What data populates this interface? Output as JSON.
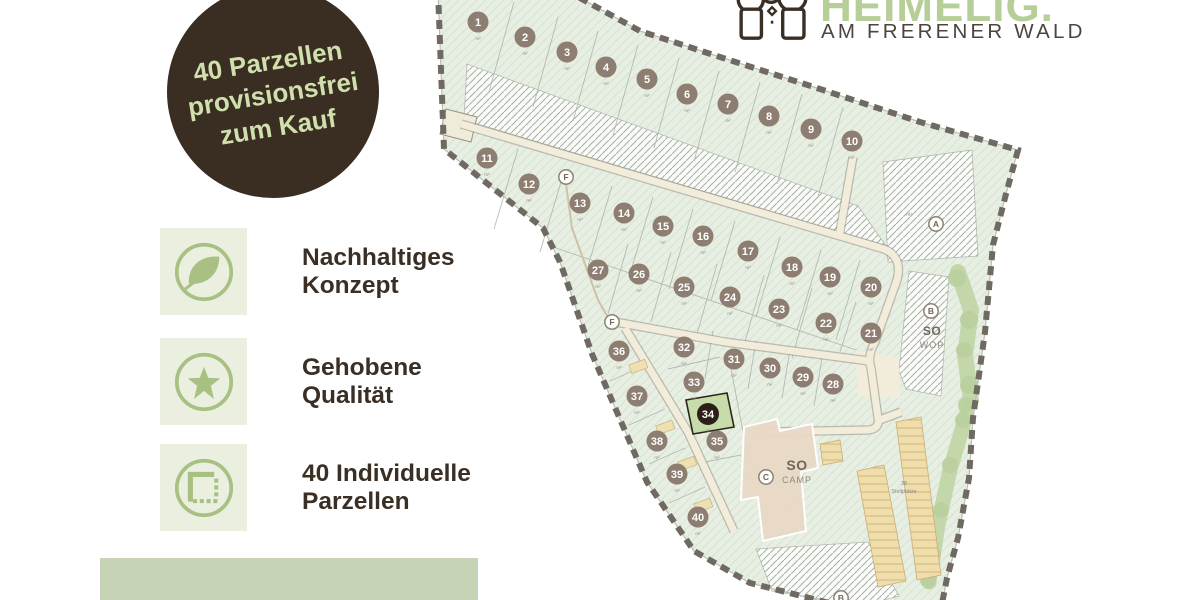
{
  "badge": {
    "lines": [
      "40 Parzellen",
      "provisionsfrei",
      "zum Kauf"
    ]
  },
  "features": [
    {
      "icon": "leaf-icon",
      "lines": [
        "Nachhaltiges",
        "Konzept"
      ]
    },
    {
      "icon": "star-icon",
      "lines": [
        "Gehobene",
        "Qualität"
      ]
    },
    {
      "icon": "plot-icon",
      "lines": [
        "40 Individuelle",
        "Parzellen"
      ]
    }
  ],
  "logo": {
    "name": "HEIMELIG.",
    "tagline": "AM FRERENER WALD"
  },
  "map": {
    "unit_label": "m²",
    "parking": {
      "count": "38",
      "label": "Stellplätze"
    },
    "markers": [
      {
        "letter": "F",
        "x": 566,
        "y": 177
      },
      {
        "letter": "F",
        "x": 612,
        "y": 322
      },
      {
        "letter": "A",
        "x": 936,
        "y": 224
      },
      {
        "letter": "B",
        "x": 931,
        "y": 311,
        "title": "SO",
        "subtitle": "WOP",
        "tx": 932,
        "ty": 335,
        "ts": 12
      },
      {
        "letter": "C",
        "x": 766,
        "y": 477,
        "title": "SO",
        "subtitle": "CAMP",
        "tx": 797,
        "ty": 470,
        "ts": 14
      },
      {
        "letter": "B",
        "x": 841,
        "y": 598
      }
    ],
    "parcels": [
      {
        "n": "1",
        "x": 478,
        "y": 22
      },
      {
        "n": "2",
        "x": 525,
        "y": 37
      },
      {
        "n": "3",
        "x": 567,
        "y": 52
      },
      {
        "n": "4",
        "x": 606,
        "y": 67
      },
      {
        "n": "5",
        "x": 647,
        "y": 79
      },
      {
        "n": "6",
        "x": 687,
        "y": 94
      },
      {
        "n": "7",
        "x": 728,
        "y": 104
      },
      {
        "n": "8",
        "x": 769,
        "y": 116
      },
      {
        "n": "9",
        "x": 811,
        "y": 129
      },
      {
        "n": "10",
        "x": 852,
        "y": 141
      },
      {
        "n": "11",
        "x": 487,
        "y": 158
      },
      {
        "n": "12",
        "x": 529,
        "y": 184
      },
      {
        "n": "13",
        "x": 580,
        "y": 203
      },
      {
        "n": "14",
        "x": 624,
        "y": 213
      },
      {
        "n": "15",
        "x": 663,
        "y": 226
      },
      {
        "n": "16",
        "x": 703,
        "y": 236
      },
      {
        "n": "17",
        "x": 748,
        "y": 251
      },
      {
        "n": "18",
        "x": 792,
        "y": 267
      },
      {
        "n": "19",
        "x": 830,
        "y": 277
      },
      {
        "n": "20",
        "x": 871,
        "y": 287
      },
      {
        "n": "21",
        "x": 871,
        "y": 333
      },
      {
        "n": "22",
        "x": 826,
        "y": 323
      },
      {
        "n": "23",
        "x": 779,
        "y": 309
      },
      {
        "n": "24",
        "x": 730,
        "y": 297
      },
      {
        "n": "25",
        "x": 684,
        "y": 287
      },
      {
        "n": "26",
        "x": 639,
        "y": 274
      },
      {
        "n": "27",
        "x": 598,
        "y": 270
      },
      {
        "n": "28",
        "x": 833,
        "y": 384
      },
      {
        "n": "29",
        "x": 803,
        "y": 377
      },
      {
        "n": "30",
        "x": 770,
        "y": 368
      },
      {
        "n": "31",
        "x": 734,
        "y": 359
      },
      {
        "n": "32",
        "x": 684,
        "y": 347
      },
      {
        "n": "33",
        "x": 694,
        "y": 382
      },
      {
        "n": "34",
        "x": 708,
        "y": 414,
        "hl": true
      },
      {
        "n": "35",
        "x": 717,
        "y": 441
      },
      {
        "n": "36",
        "x": 619,
        "y": 351
      },
      {
        "n": "37",
        "x": 637,
        "y": 396
      },
      {
        "n": "38",
        "x": 657,
        "y": 441
      },
      {
        "n": "39",
        "x": 677,
        "y": 474
      },
      {
        "n": "40",
        "x": 698,
        "y": 517
      }
    ]
  },
  "colors": {
    "badge_bg": "#3a2d22",
    "badge_text": "#cfe0ad",
    "accent_green": "#a9c083",
    "icon_bg": "#eaefe0",
    "heading_text": "#3a2f25",
    "logo_green": "#b6ce98",
    "bar_green": "#c6d3b4",
    "site_fill": "#e7eee2",
    "road_fill": "#f2ecda",
    "boundary_dash": "#6f6961",
    "marker_fill": "#8d7e71",
    "marker_highlight": "#2c2016",
    "highlight_parcel": "#c6dcab"
  }
}
